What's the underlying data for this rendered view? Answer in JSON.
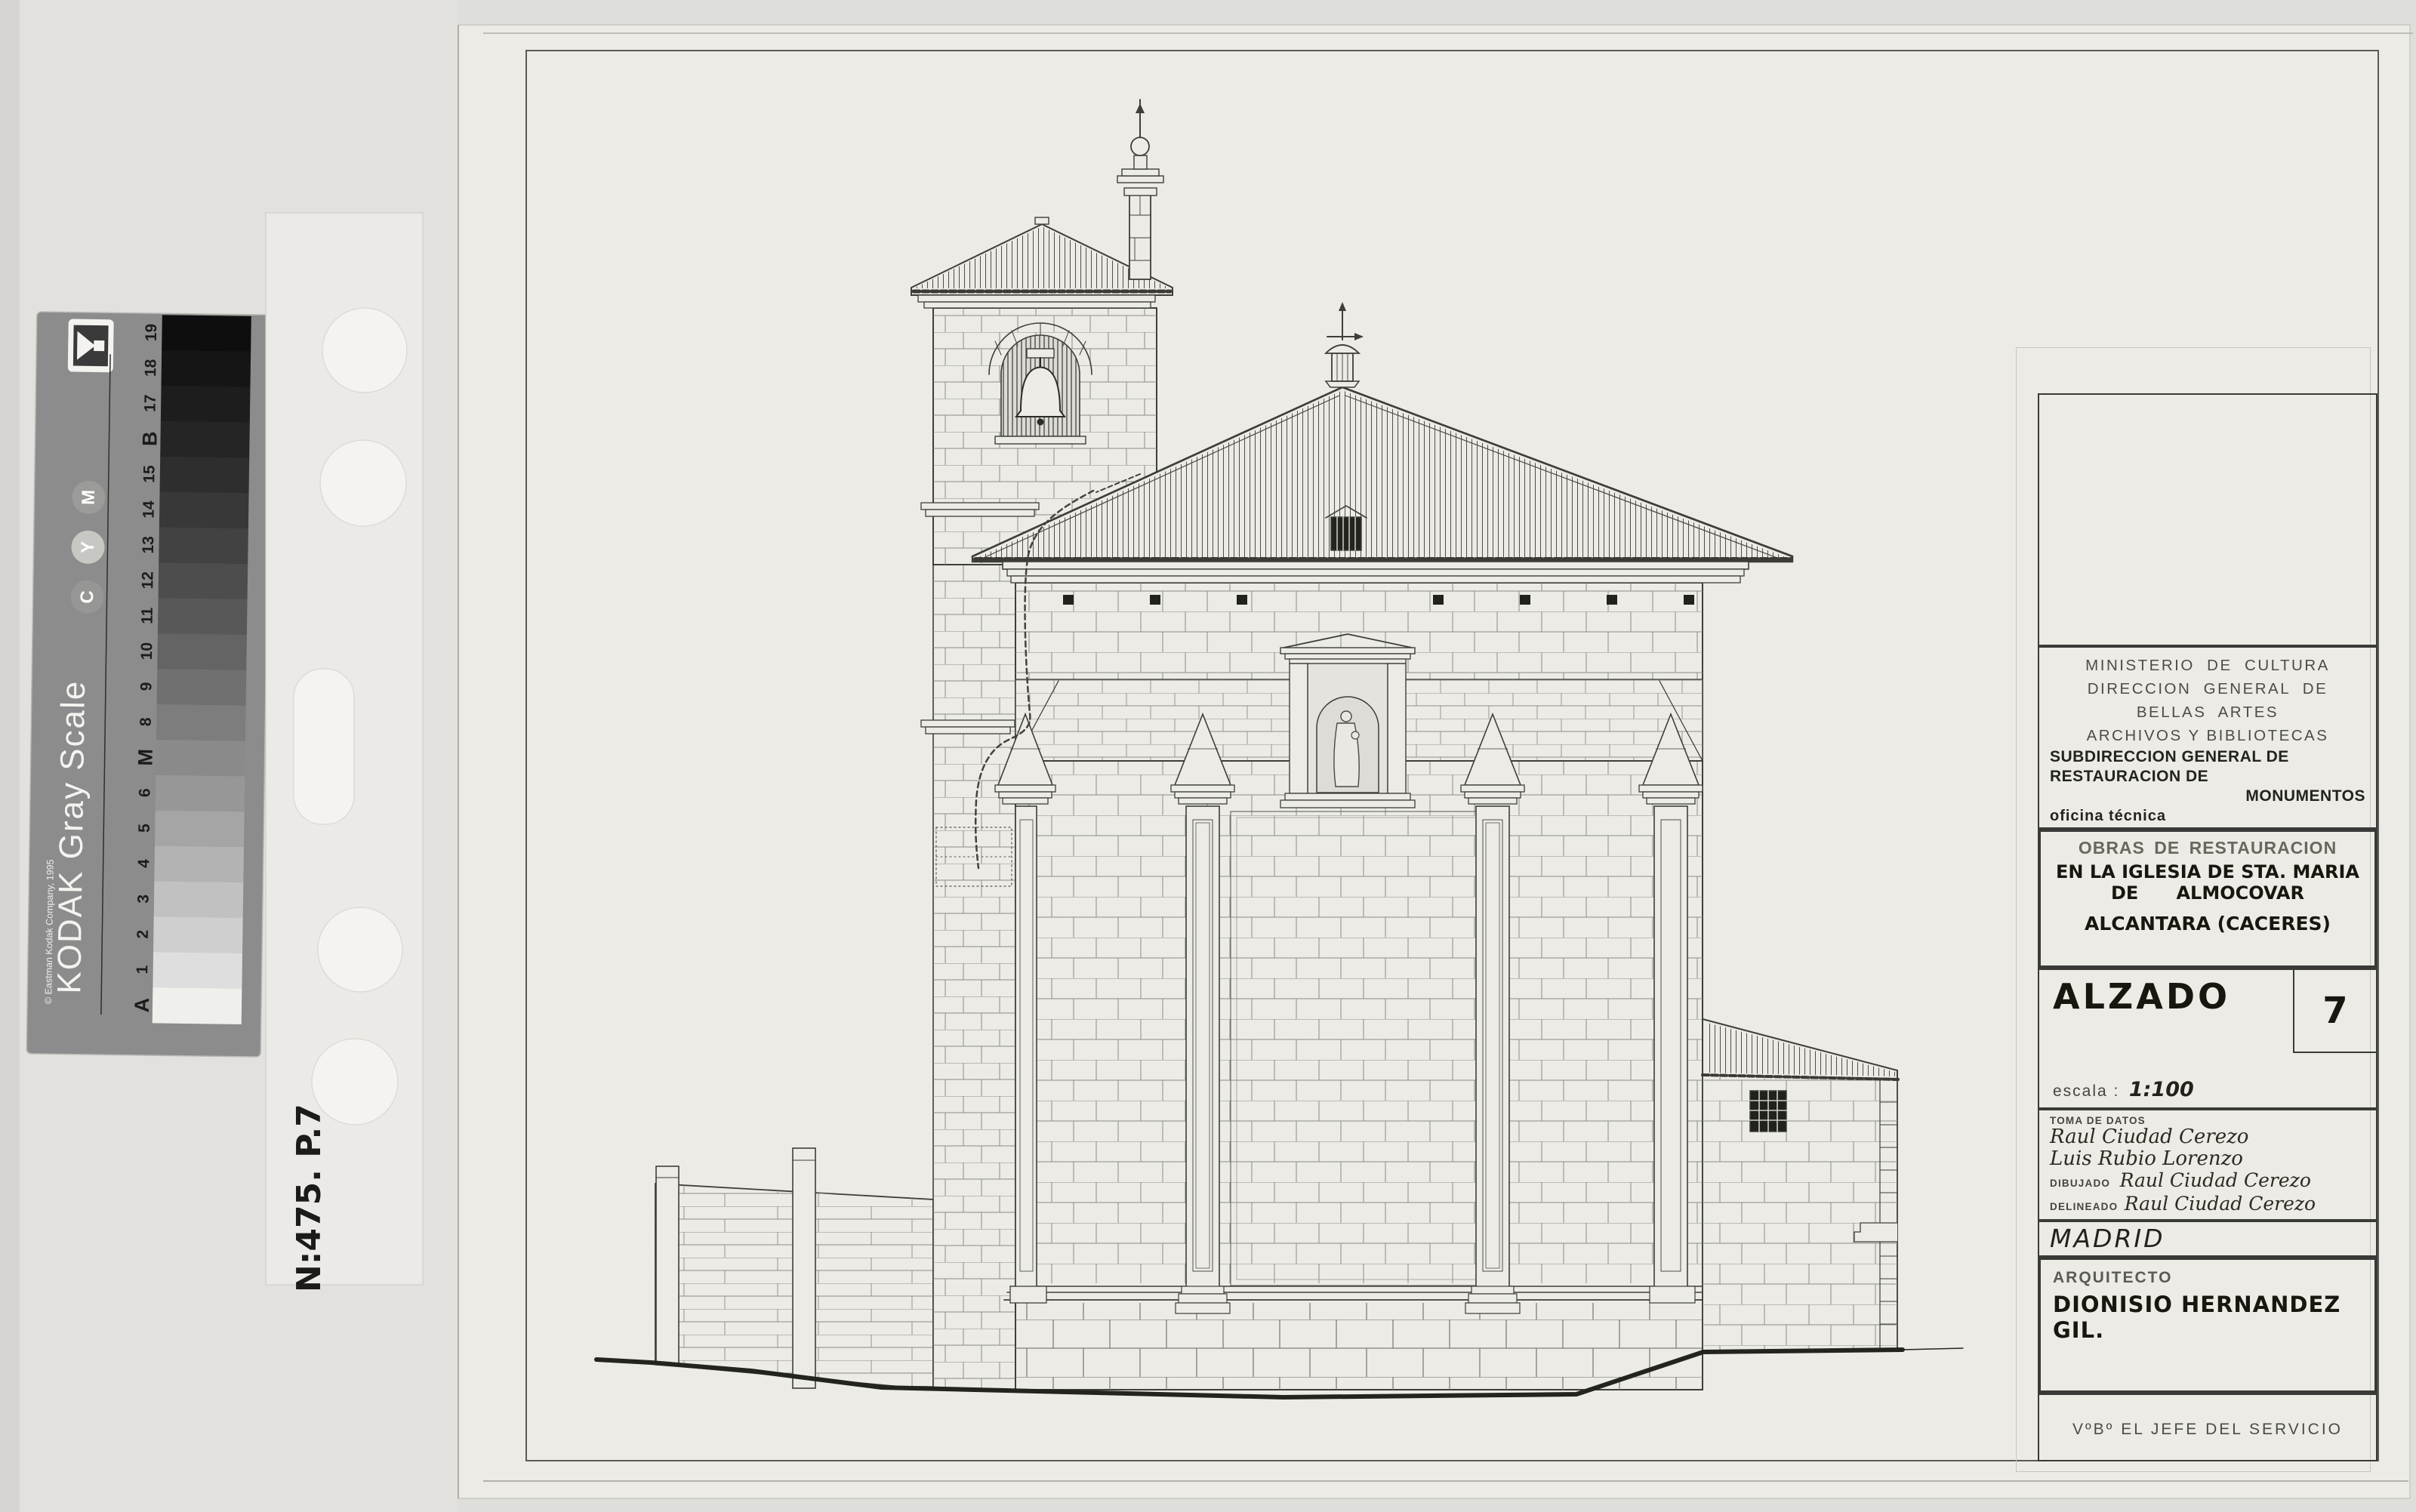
{
  "colors": {
    "background": "#dededb",
    "sheet_paper": "#ecebe6",
    "ink": "#3e3e3a",
    "kodak_strip_gray": "#8c8c8c",
    "ground_ink": "#24241f"
  },
  "kodak_strip": {
    "brand": "Kodak",
    "title": "KODAK Gray Scale",
    "copyright": "© Eastman Kodak Company, 1995",
    "cmy_top_to_bottom": [
      "M",
      "Y",
      "C"
    ],
    "patches": [
      {
        "label": "19",
        "gray": "#0e0e0e"
      },
      {
        "label": "18",
        "gray": "#151515"
      },
      {
        "label": "17",
        "gray": "#1d1d1d"
      },
      {
        "label": "B",
        "gray": "#252525"
      },
      {
        "label": "15",
        "gray": "#2e2e2e"
      },
      {
        "label": "14",
        "gray": "#383838"
      },
      {
        "label": "13",
        "gray": "#424242"
      },
      {
        "label": "12",
        "gray": "#4d4d4d"
      },
      {
        "label": "11",
        "gray": "#585858"
      },
      {
        "label": "10",
        "gray": "#646464"
      },
      {
        "label": "9",
        "gray": "#707070"
      },
      {
        "label": "8",
        "gray": "#7d7d7d"
      },
      {
        "label": "M",
        "gray": "#8a8a8a"
      },
      {
        "label": "6",
        "gray": "#979797"
      },
      {
        "label": "5",
        "gray": "#a5a5a5"
      },
      {
        "label": "4",
        "gray": "#b3b3b3"
      },
      {
        "label": "3",
        "gray": "#c1c1c1"
      },
      {
        "label": "2",
        "gray": "#cfcfcf"
      },
      {
        "label": "1",
        "gray": "#dedede"
      },
      {
        "label": "A",
        "gray": "#efefec"
      }
    ]
  },
  "film_note": {
    "text": "N:475. P.7"
  },
  "title_block": {
    "ministry": {
      "lines": [
        "MINISTERIO  DE  CULTURA",
        "DIRECCION  GENERAL  DE",
        "BELLAS  ARTES",
        "ARCHIVOS Y BIBLIOTECAS"
      ],
      "bold_lines": [
        "SUBDIRECCION GENERAL DE",
        "RESTAURACION DE",
        "MONUMENTOS"
      ],
      "office": "oficina técnica"
    },
    "project": {
      "header": "OBRAS DE RESTAURACION",
      "line1": "EN LA IGLESIA DE STA. MARIA",
      "line2": "DE      ALMOCOVAR",
      "line3": "ALCANTARA (CACERES)"
    },
    "sheet": {
      "title": "ALZADO",
      "number": "7",
      "scale_label": "escala :",
      "scale_value": "1:100"
    },
    "credits": {
      "toma_label": "TOMA DE DATOS",
      "toma_names": [
        "Raul Ciudad Cerezo",
        "Luis Rubio Lorenzo"
      ],
      "dibujado_label": "DIBUJADO",
      "dibujado_name": "Raul Ciudad Cerezo",
      "delineado_label": "DELINEADO",
      "delineado_name": "Raul Ciudad Cerezo"
    },
    "city": "MADRID",
    "architect": {
      "label": "ARQUITECTO",
      "name": "DIONISIO HERNANDEZ GIL."
    },
    "approval": "VºBº EL JEFE DEL SERVICIO"
  }
}
